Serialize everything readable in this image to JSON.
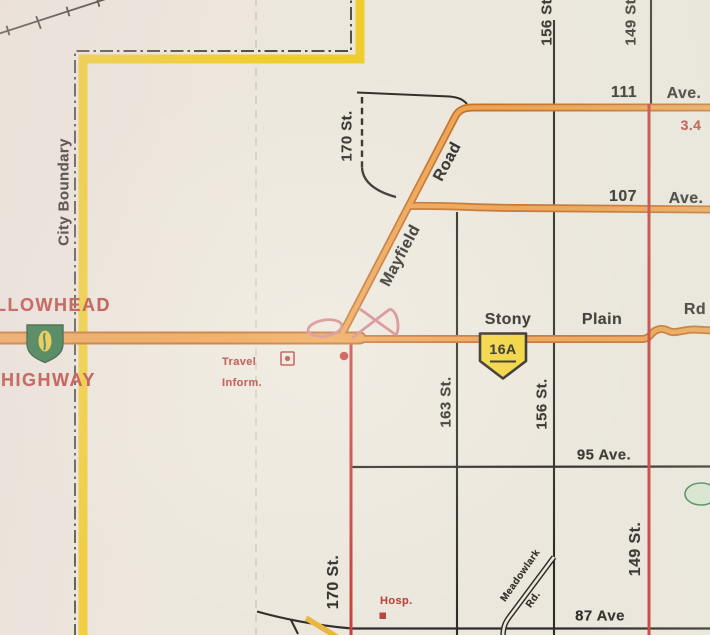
{
  "map": {
    "boundary": {
      "label": "City Boundary"
    },
    "highway_name": {
      "line1": "YELLOWHEAD",
      "line2": "HIGHWAY"
    },
    "shields": {
      "stony_plain": "16A"
    },
    "streets": {
      "st170_top": "170 St.",
      "st170_bottom": "170 St.",
      "st163": "163 St.",
      "st156_top": "156 St.",
      "st156_mid": "156 St.",
      "st149_top": "149 St.",
      "st149_bottom": "149 St."
    },
    "avenues": {
      "ave111_num": "111",
      "ave111_suf": "Ave.",
      "ave107_num": "107",
      "ave107_suf": "Ave.",
      "ave95": "95 Ave.",
      "ave87": "87 Ave"
    },
    "roads": {
      "mayfield_word1": "Mayfield",
      "mayfield_word2": "Road",
      "stony": "Stony",
      "plain": "Plain",
      "rd": "Rd",
      "meadowlark_word1": "Meadowlark",
      "meadowlark_word2": "Rd."
    },
    "annotations": {
      "distance": "3.4",
      "travel_line1": "Travel",
      "travel_line2": "Inform.",
      "hospital": "Hosp."
    },
    "colors": {
      "paper": "#ece7dd",
      "highway_orange_fill": "#eda24f",
      "highway_orange_casing": "#c2702a",
      "boundary_yellow": "#f0cd2e",
      "arterial_red": "#c4403a",
      "ramp_pink": "#d2868a",
      "minor_ink": "#2e2c28",
      "label_red": "#b8423c",
      "shield16a_yellow": "#f2d43b",
      "shield16_green": "#27713f",
      "park_green": "#d7e7d0"
    }
  }
}
